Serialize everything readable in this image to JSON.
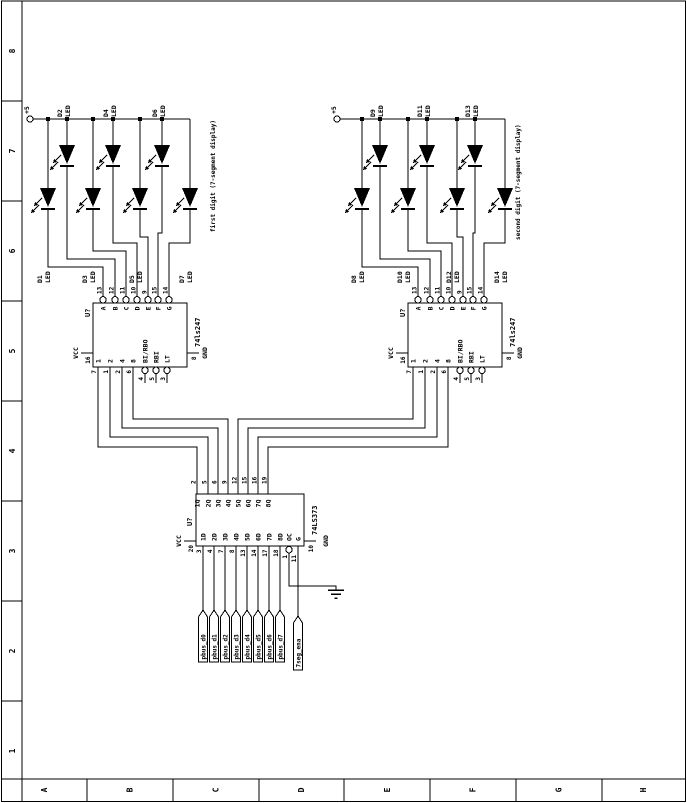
{
  "border": {
    "bottom_zone_letters": [
      "A",
      "B",
      "C",
      "D",
      "E",
      "F",
      "G",
      "H"
    ],
    "left_zone_numbers": [
      "8",
      "7",
      "6",
      "5",
      "4",
      "3",
      "2",
      "1"
    ]
  },
  "power": {
    "rail_label": "+5"
  },
  "led_type_label": "LED",
  "displays": [
    {
      "title": "first digit (7-segment display)",
      "leds": [
        {
          "ref": "D1"
        },
        {
          "ref": "D2"
        },
        {
          "ref": "D3"
        },
        {
          "ref": "D4"
        },
        {
          "ref": "D5"
        },
        {
          "ref": "D6"
        },
        {
          "ref": "D7"
        }
      ]
    },
    {
      "title": "second digit (7-segment display)",
      "leds": [
        {
          "ref": "D8"
        },
        {
          "ref": "D9"
        },
        {
          "ref": "D10"
        },
        {
          "ref": "D11"
        },
        {
          "ref": "D12"
        },
        {
          "ref": "D13"
        },
        {
          "ref": "D14"
        }
      ]
    }
  ],
  "decoder": {
    "refdes": "U?",
    "device": "74ls247",
    "outputs": [
      {
        "name": "A",
        "pin": "13"
      },
      {
        "name": "B",
        "pin": "12"
      },
      {
        "name": "C",
        "pin": "11"
      },
      {
        "name": "D",
        "pin": "10"
      },
      {
        "name": "E",
        "pin": "9"
      },
      {
        "name": "F",
        "pin": "15"
      },
      {
        "name": "G",
        "pin": "14"
      }
    ],
    "inputs": [
      {
        "name": "1",
        "pin": "7"
      },
      {
        "name": "2",
        "pin": "1"
      },
      {
        "name": "4",
        "pin": "2"
      },
      {
        "name": "8",
        "pin": "6"
      }
    ],
    "controls": [
      {
        "name": "BI/RBO",
        "pin": "4"
      },
      {
        "name": "RBI",
        "pin": "5"
      },
      {
        "name": "LT",
        "pin": "3"
      }
    ],
    "vcc_label": "VCC",
    "vcc_pin": "16",
    "gnd_label": "GND",
    "gnd_pin": "8"
  },
  "latch": {
    "refdes": "U?",
    "device": "74LS373",
    "inputs": [
      {
        "name": "1D",
        "pin": "3"
      },
      {
        "name": "2D",
        "pin": "4"
      },
      {
        "name": "3D",
        "pin": "7"
      },
      {
        "name": "4D",
        "pin": "8"
      },
      {
        "name": "5D",
        "pin": "13"
      },
      {
        "name": "6D",
        "pin": "14"
      },
      {
        "name": "7D",
        "pin": "17"
      },
      {
        "name": "8D",
        "pin": "18"
      }
    ],
    "outputs": [
      {
        "name": "1Q",
        "pin": "2"
      },
      {
        "name": "2Q",
        "pin": "5"
      },
      {
        "name": "3Q",
        "pin": "6"
      },
      {
        "name": "4Q",
        "pin": "9"
      },
      {
        "name": "5Q",
        "pin": "12"
      },
      {
        "name": "6Q",
        "pin": "15"
      },
      {
        "name": "7Q",
        "pin": "16"
      },
      {
        "name": "8Q",
        "pin": "19"
      }
    ],
    "oc": {
      "name": "OC",
      "pin": "1"
    },
    "g": {
      "name": "G",
      "pin": "11"
    },
    "vcc_label": "VCC",
    "vcc_pin": "20",
    "gnd_label": "GND",
    "gnd_pin": "10"
  },
  "nets": {
    "data_flags": [
      "pbus_d0",
      "pbus_d1",
      "pbus_d2",
      "pbus_d3",
      "pbus_d4",
      "pbus_d5",
      "pbus_d6",
      "pbus_d7"
    ],
    "enable_flag": "7seg_ena"
  },
  "colors": {
    "ink": "#000000",
    "background": "#ffffff"
  }
}
